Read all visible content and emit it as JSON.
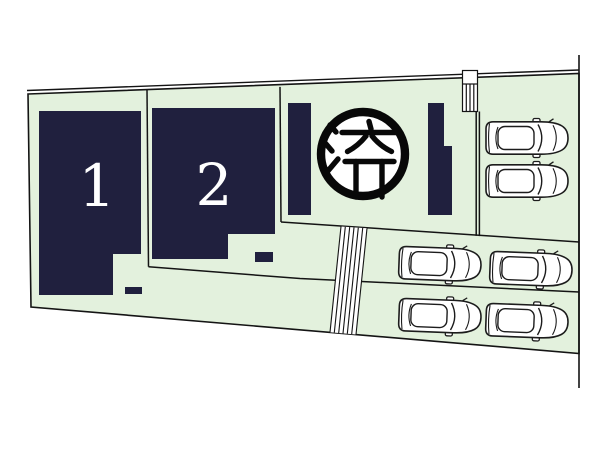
{
  "plan": {
    "kind": "residential-lot-layout",
    "lots": [
      {
        "number": "1",
        "status": "available"
      },
      {
        "number": "2",
        "status": "available"
      },
      {
        "number": "3",
        "status": "sold",
        "seal_text": "済"
      }
    ],
    "parking": {
      "cars_count": 6
    },
    "colors": {
      "page_background": "#ffffff",
      "land": "#e3f1dd",
      "building": "#20203e",
      "line": "#141414",
      "seal_ink": "#080808",
      "lot_number_text": "#ffffff",
      "car_fill": "#ffffff",
      "car_outline": "#1c1c1c"
    }
  }
}
